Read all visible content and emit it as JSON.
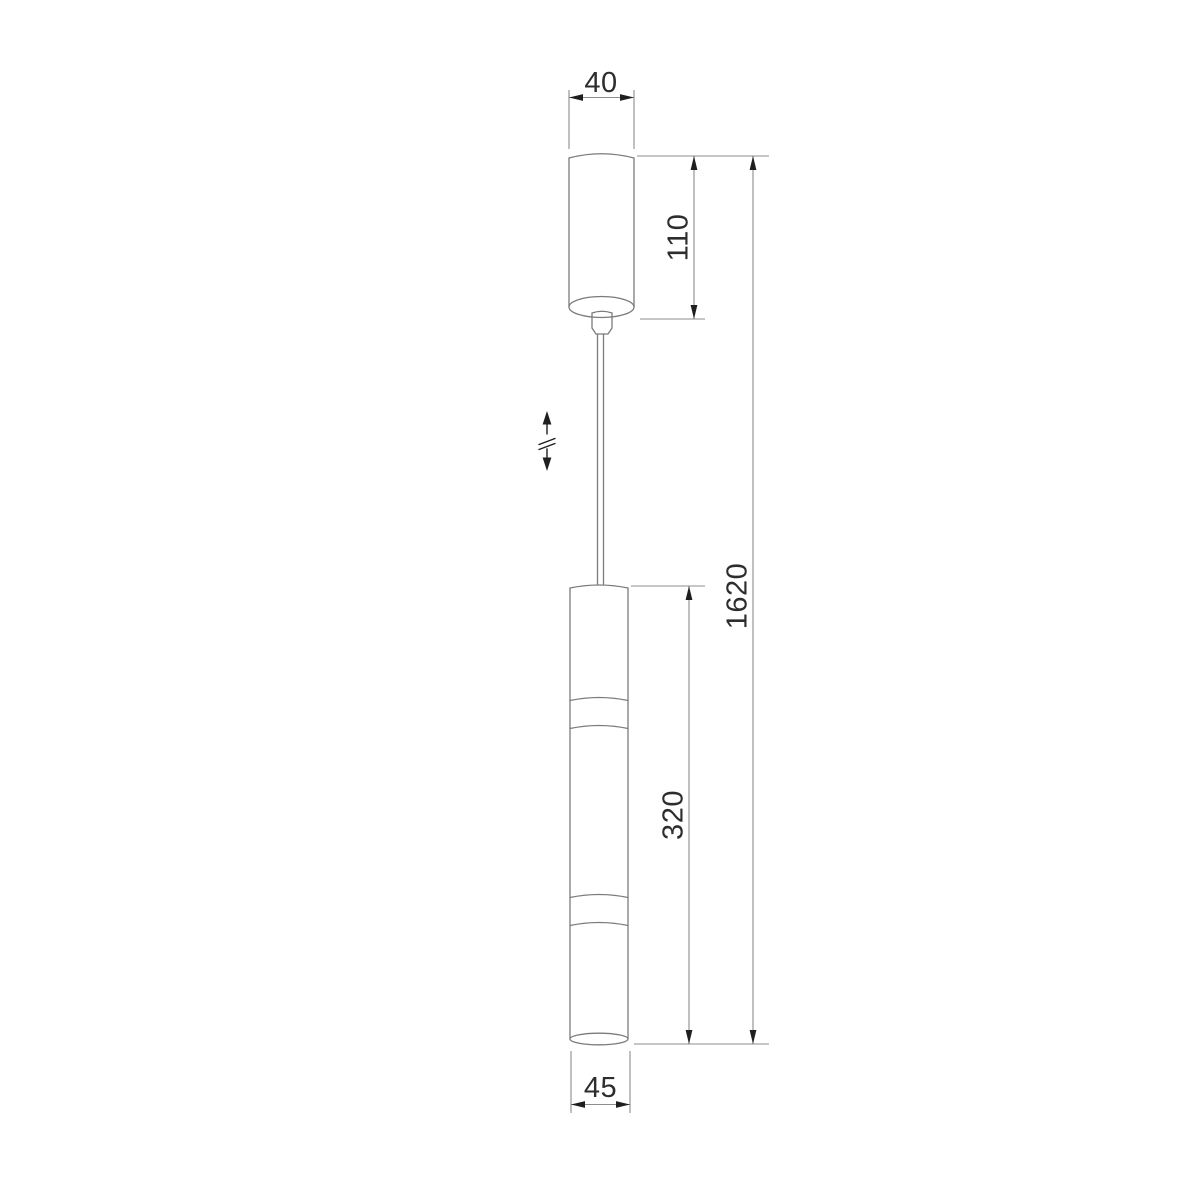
{
  "drawing": {
    "colors": {
      "outline": "#7b7b7b",
      "dimension_line": "#8d8d8d",
      "arrow": "#1f1f1f",
      "text": "#2d2d2d",
      "background": "#ffffff"
    },
    "icons": {
      "height_adjustable": "up-down-adjustable-cable-arrow-icon"
    },
    "dimensions": {
      "canopy_width": "40",
      "canopy_height": "110",
      "overall_height": "1620",
      "body_height": "320",
      "body_diameter": "45"
    }
  }
}
